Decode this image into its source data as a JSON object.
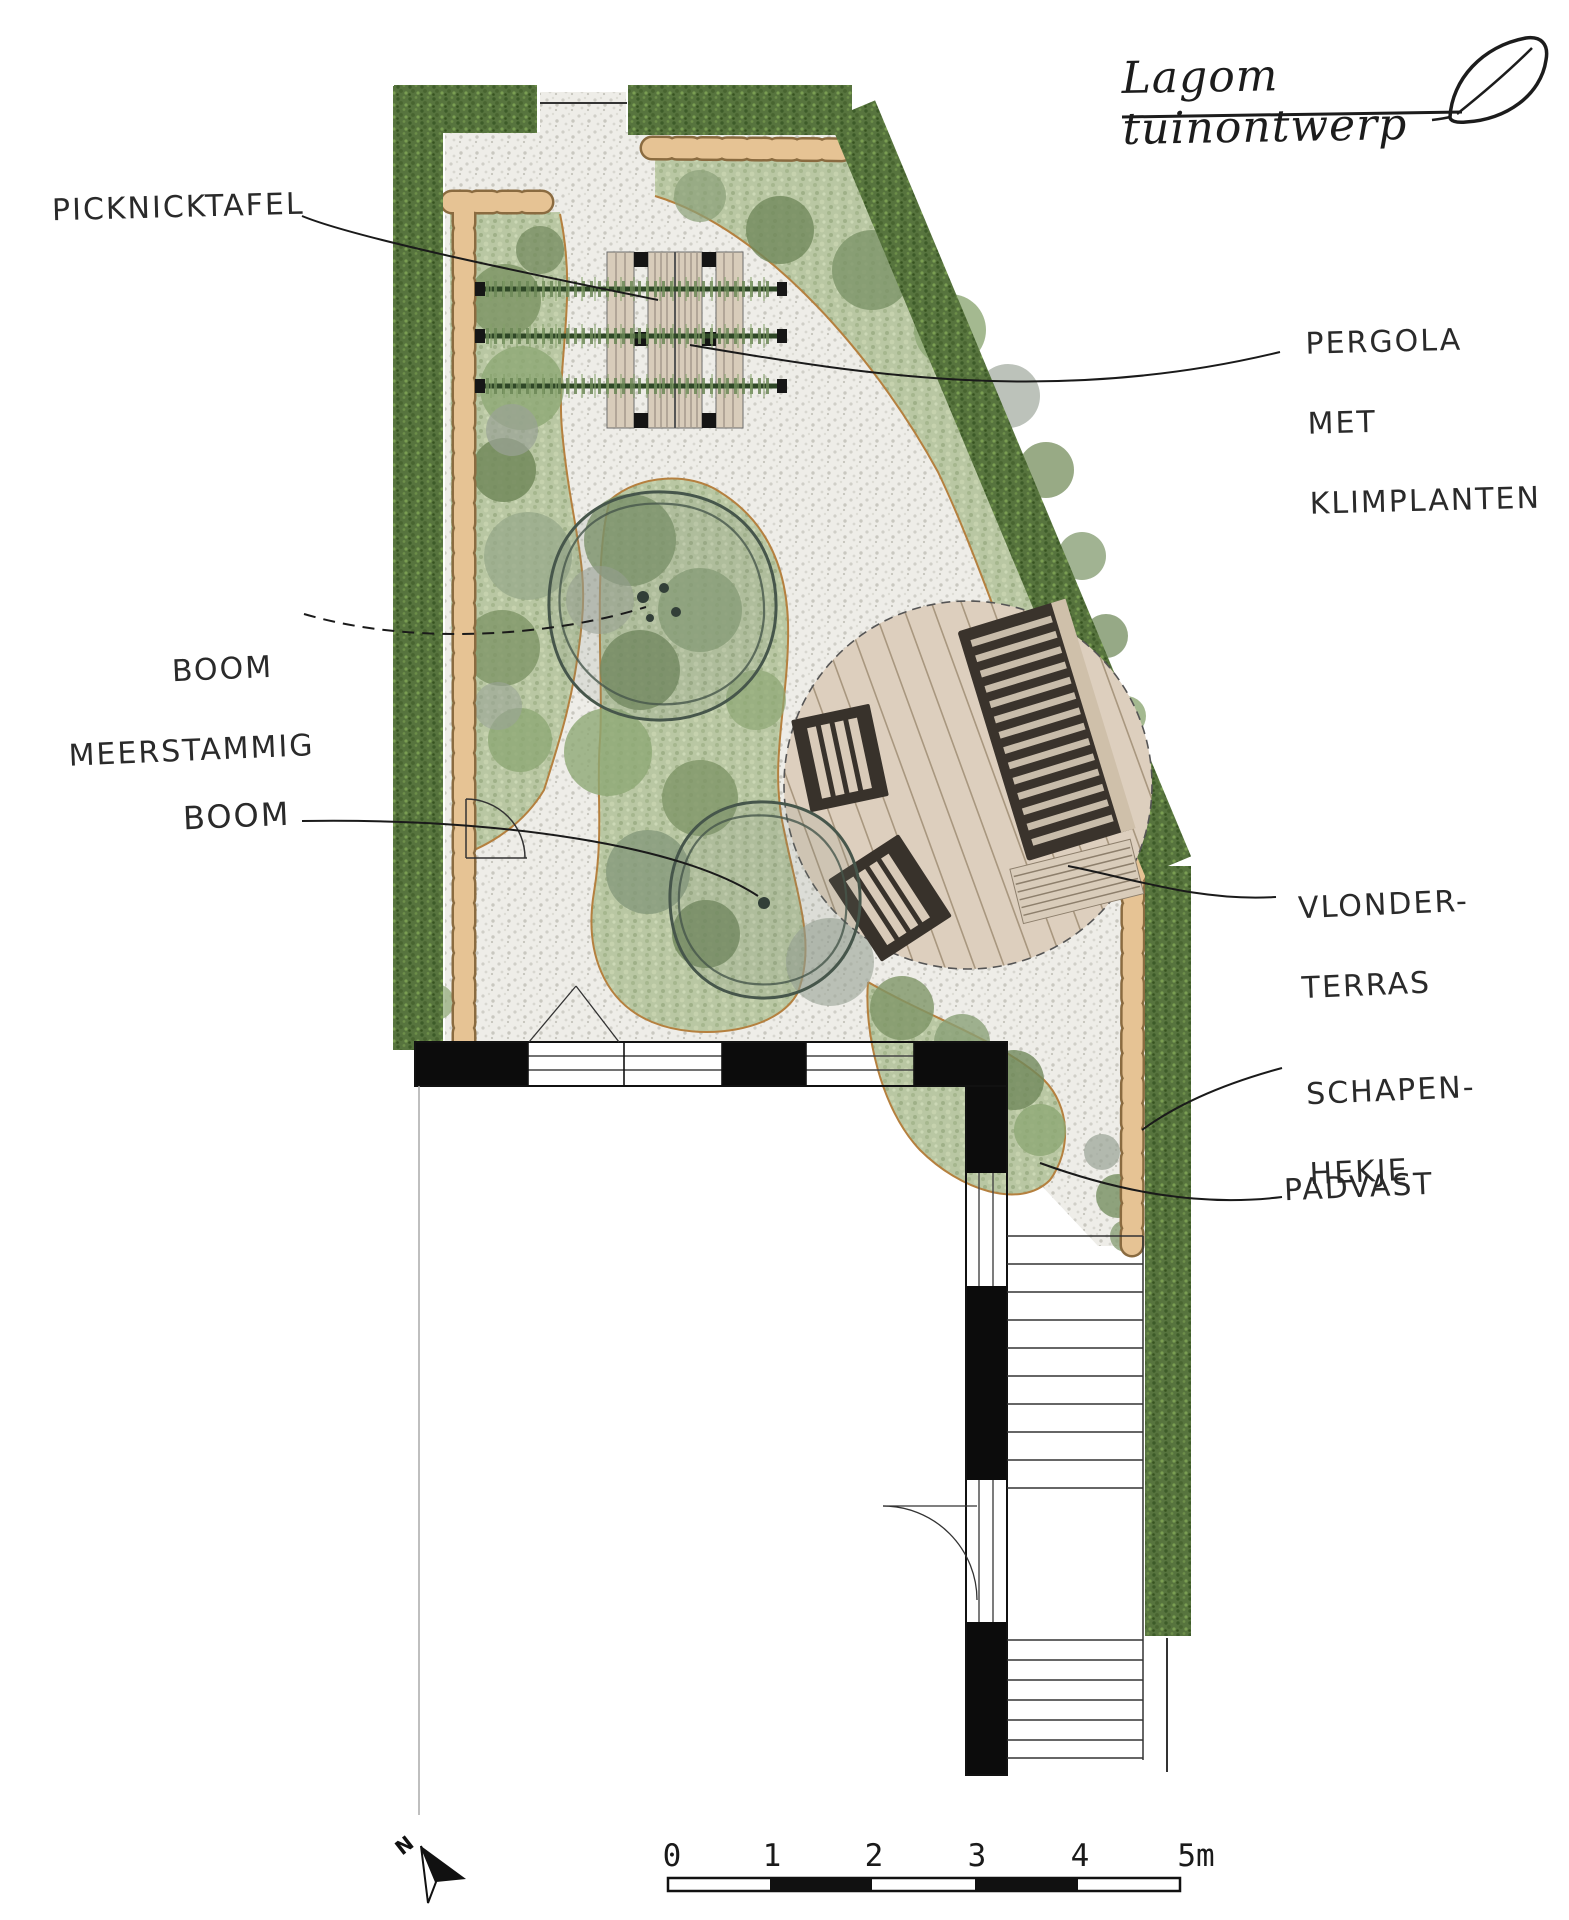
{
  "logo": {
    "brand": "Lagom tuinontwerp",
    "icon": "leaf-icon"
  },
  "labels": {
    "picknicktafel": "PICKNICKTAFEL",
    "boom_meerstammig_line1": "BOOM",
    "boom_meerstammig_line2": "MEERSTAMMIG",
    "boom": "BOOM",
    "pergola_line1": "PERGOLA",
    "pergola_line2": "MET",
    "pergola_line3": "KLIMPLANTEN",
    "vlonder_line1": "VLONDER-",
    "vlonder_line2": "TERRAS",
    "schapenhekje_line1": "SCHAPEN-",
    "schapenhekje_line2": "HEKJE",
    "padvast": "PADVAST"
  },
  "scalebar": {
    "labels": [
      "0",
      "1",
      "2",
      "3",
      "4",
      "5m"
    ]
  },
  "north": {
    "label": "N"
  },
  "colors": {
    "hedge_green": "#57743e",
    "bed_green": "#b9c7a3",
    "gravel": "#eeede8",
    "stone_beige": "#e6c394",
    "deck_beige": "#ddcfbe",
    "furniture_dark": "#3a332c",
    "wood_tan": "#d8ccba",
    "line_ink": "#1a1a1a"
  }
}
